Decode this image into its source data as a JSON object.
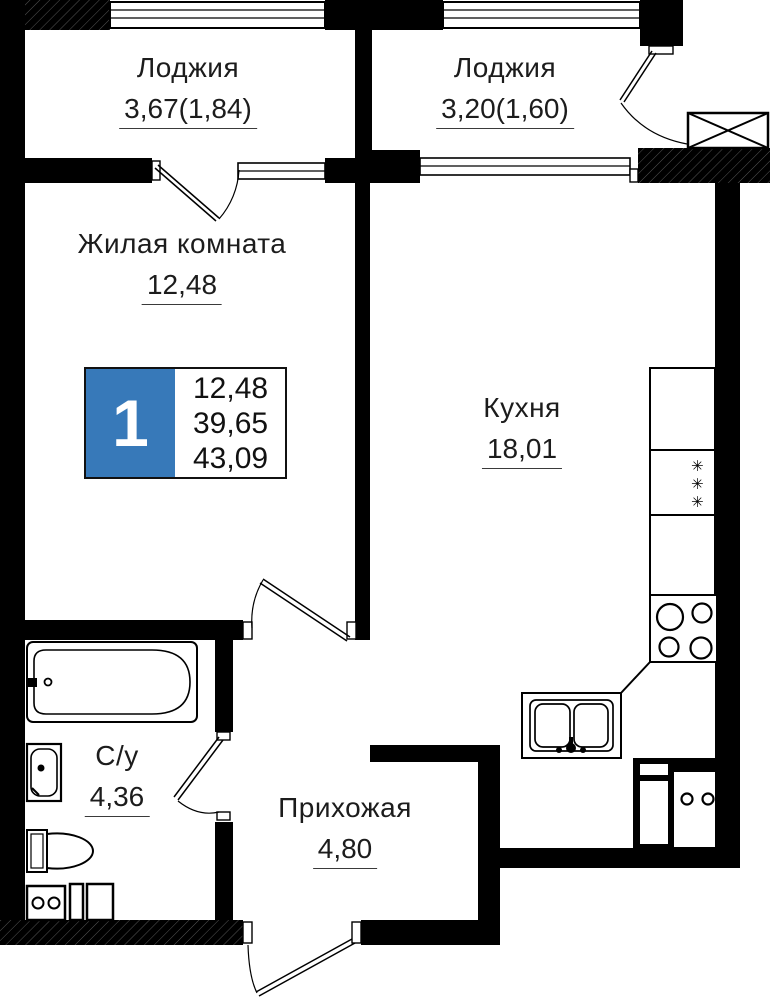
{
  "plan": {
    "rooms": [
      {
        "id": "loggia-left",
        "name": "Лоджия",
        "area": "3,67(1,84)"
      },
      {
        "id": "loggia-right",
        "name": "Лоджия",
        "area": "3,20(1,60)"
      },
      {
        "id": "living-room",
        "name": "Жилая комната",
        "area": "12,48"
      },
      {
        "id": "kitchen",
        "name": "Кухня",
        "area": "18,01"
      },
      {
        "id": "bathroom",
        "name": "С/у",
        "area": "4,36"
      },
      {
        "id": "hallway",
        "name": "Прихожая",
        "area": "4,80"
      }
    ],
    "badge": {
      "rooms_count": "1",
      "living_area": "12,48",
      "area_without_loggia": "39,65",
      "total_area": "43,09",
      "accent_color": "#3779B9"
    },
    "icons": {
      "fridge_snowflakes": "✳\n✳\n✳"
    }
  }
}
